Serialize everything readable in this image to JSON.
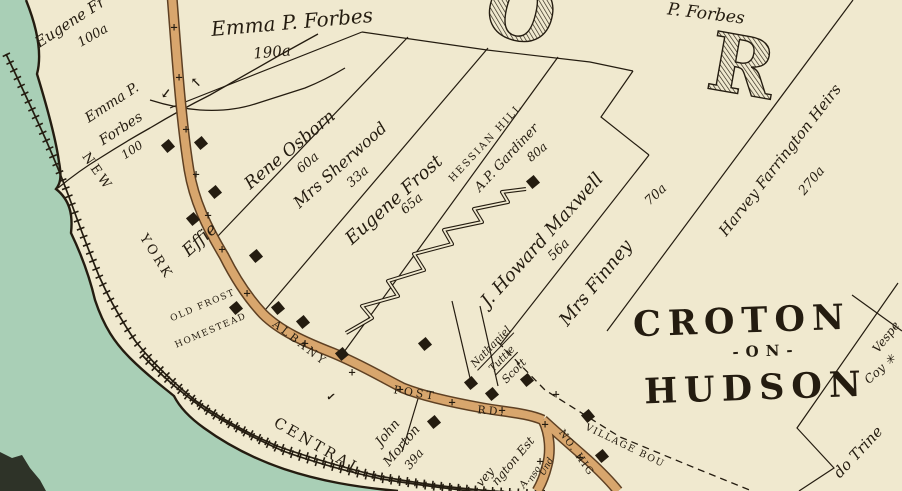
{
  "palette": {
    "paper": "#f0e9cf",
    "water": "#a9cfb6",
    "ink": "#241c10",
    "road-fill": "#d8a66d",
    "road-casing": "#5e4023",
    "blob": "#2e3328"
  },
  "map": {
    "region_title_big_letters": [
      "O",
      "R"
    ],
    "place_name": "CROTON -ON- HUDSON",
    "railroad_name": "NEW YORK CENTRAL",
    "roads": [
      "ALBANY POST RD.",
      "NO. HIG",
      "VILLAGE BOU"
    ],
    "landmark": "OLD FROST HOMESTEAD",
    "parcels": [
      {
        "owner": "Eugene Fr",
        "acreage": "100a"
      },
      {
        "owner": "Emma P. Forbes",
        "acreage": "190a"
      },
      {
        "owner": "Emma P. Forbes",
        "acreage": "100"
      },
      {
        "owner": "P. Forbes",
        "acreage": ""
      },
      {
        "owner": "Effie Rene Osborn",
        "acreage": "60a"
      },
      {
        "owner": "Mrs Sherwood",
        "acreage": "33a"
      },
      {
        "owner": "Eugene Frost",
        "acreage": "65a"
      },
      {
        "owner": "A.P. Gardiner (Hessian Hill)",
        "acreage": "80a"
      },
      {
        "owner": "J. Howard Maxwell",
        "acreage": "56a"
      },
      {
        "owner": "Mrs Finney",
        "acreage": "70a"
      },
      {
        "owner": "Harvey Farrington Heirs",
        "acreage": "270a"
      },
      {
        "owner": "John Morton",
        "acreage": "39a"
      },
      {
        "owner": "Nathaniel Tuttle",
        "acreage": ""
      },
      {
        "owner": "Scott",
        "acreage": ""
      },
      {
        "owner": "Vespe",
        "acreage": ""
      },
      {
        "owner": "Coy",
        "acreage": ""
      },
      {
        "owner": "do Trine",
        "acreage": ""
      }
    ]
  },
  "labels": [
    {
      "name": "parcel-label-eugene-fr",
      "text": "Eugene Fr",
      "x": 70,
      "y": 22,
      "rot": -33,
      "size": 15,
      "cls": "name"
    },
    {
      "name": "acreage-label",
      "text": "100a",
      "x": 93,
      "y": 36,
      "rot": -30,
      "size": 13,
      "cls": "acre"
    },
    {
      "name": "parcel-label-emma-forbes",
      "text": "Emma P. Forbes",
      "x": 292,
      "y": 22,
      "rot": -5,
      "size": 20,
      "cls": "name"
    },
    {
      "name": "acreage-label",
      "text": "190a",
      "x": 272,
      "y": 52,
      "rot": -5,
      "size": 15,
      "cls": "acre"
    },
    {
      "name": "parcel-label-emma-forbes-2",
      "text": "Emma P.",
      "x": 112,
      "y": 103,
      "rot": -33,
      "size": 14,
      "cls": "name"
    },
    {
      "name": "parcel-label-emma-forbes-2",
      "text": "Forbes",
      "x": 121,
      "y": 129,
      "rot": -33,
      "size": 14,
      "cls": "name"
    },
    {
      "name": "acreage-label",
      "text": "100",
      "x": 132,
      "y": 150,
      "rot": -33,
      "size": 12,
      "cls": "acre"
    },
    {
      "name": "parcel-label-p-forbes",
      "text": "P. Forbes",
      "x": 706,
      "y": 14,
      "rot": 7,
      "size": 17,
      "cls": "name"
    },
    {
      "name": "parcel-label-effie",
      "text": "Effie",
      "x": 200,
      "y": 240,
      "rot": -42,
      "size": 17,
      "cls": "name"
    },
    {
      "name": "parcel-label-rene-osborn",
      "text": "Rene Osborn",
      "x": 290,
      "y": 150,
      "rot": -40,
      "size": 17,
      "cls": "name"
    },
    {
      "name": "acreage-label",
      "text": "60a",
      "x": 308,
      "y": 163,
      "rot": -40,
      "size": 13,
      "cls": "acre"
    },
    {
      "name": "parcel-label-mrs-sherwood",
      "text": "Mrs Sherwood",
      "x": 340,
      "y": 165,
      "rot": -42,
      "size": 16,
      "cls": "name"
    },
    {
      "name": "acreage-label",
      "text": "33a",
      "x": 358,
      "y": 177,
      "rot": -42,
      "size": 13,
      "cls": "acre"
    },
    {
      "name": "parcel-label-eugene-frost",
      "text": "Eugene Frost",
      "x": 394,
      "y": 200,
      "rot": -42,
      "size": 18,
      "cls": "name"
    },
    {
      "name": "acreage-label",
      "text": "65a",
      "x": 412,
      "y": 204,
      "rot": -40,
      "size": 13,
      "cls": "acre"
    },
    {
      "name": "place-label-hessian-hill",
      "text": "HESSIAN HILL",
      "x": 486,
      "y": 143,
      "rot": -47,
      "size": 10,
      "cls": "caps"
    },
    {
      "name": "parcel-label-gardiner",
      "text": "A.P. Gardiner",
      "x": 507,
      "y": 158,
      "rot": -47,
      "size": 13,
      "cls": "name"
    },
    {
      "name": "acreage-label",
      "text": "80a",
      "x": 537,
      "y": 152,
      "rot": -40,
      "size": 12,
      "cls": "acre"
    },
    {
      "name": "parcel-label-maxwell",
      "text": "J. Howard Maxwell",
      "x": 542,
      "y": 240,
      "rot": -48,
      "size": 18,
      "cls": "name"
    },
    {
      "name": "acreage-label",
      "text": "56a",
      "x": 559,
      "y": 250,
      "rot": -45,
      "size": 13,
      "cls": "acre"
    },
    {
      "name": "parcel-label-mrs-finney",
      "text": "Mrs Finney",
      "x": 596,
      "y": 283,
      "rot": -51,
      "size": 18,
      "cls": "name"
    },
    {
      "name": "acreage-label",
      "text": "70a",
      "x": 656,
      "y": 195,
      "rot": -43,
      "size": 13,
      "cls": "acre"
    },
    {
      "name": "parcel-label-farrington",
      "text": "Harvey Farrington Heirs",
      "x": 780,
      "y": 160,
      "rot": -52,
      "size": 15,
      "cls": "name"
    },
    {
      "name": "acreage-label",
      "text": "270a",
      "x": 812,
      "y": 181,
      "rot": -50,
      "size": 13,
      "cls": "acre"
    },
    {
      "name": "place-label-croton",
      "text": "CROTON",
      "x": 742,
      "y": 321,
      "rot": -2,
      "size": 35,
      "cls": "bigcaps"
    },
    {
      "name": "place-label-on",
      "text": "-ON-",
      "x": 766,
      "y": 351,
      "rot": -2,
      "size": 15,
      "cls": "bigcaps"
    },
    {
      "name": "place-label-hudson",
      "text": "HUDSON",
      "x": 756,
      "y": 388,
      "rot": -2,
      "size": 35,
      "cls": "bigcaps"
    },
    {
      "name": "railroad-label-new",
      "text": "NEW",
      "x": 97,
      "y": 172,
      "rot": 55,
      "size": 13,
      "cls": "roadcaps"
    },
    {
      "name": "railroad-label-york",
      "text": "YORK",
      "x": 156,
      "y": 257,
      "rot": 58,
      "size": 13,
      "cls": "roadcaps"
    },
    {
      "name": "railroad-label-central",
      "text": "CENTRAL",
      "x": 318,
      "y": 446,
      "rot": 30,
      "size": 15,
      "cls": "roadcaps"
    },
    {
      "name": "road-label-albany",
      "text": "ALBANY",
      "x": 300,
      "y": 343,
      "rot": 38,
      "size": 11,
      "cls": "roadcaps"
    },
    {
      "name": "road-label-post",
      "text": "POST",
      "x": 415,
      "y": 393,
      "rot": 9,
      "size": 11,
      "cls": "roadcaps"
    },
    {
      "name": "road-label-rd",
      "text": "RD.",
      "x": 492,
      "y": 411,
      "rot": 5,
      "size": 11,
      "cls": "roadcaps"
    },
    {
      "name": "landmark-label-old-frost",
      "text": "OLD FROST",
      "x": 203,
      "y": 306,
      "rot": -23,
      "size": 9,
      "cls": "capsS"
    },
    {
      "name": "landmark-label-homestead",
      "text": "HOMESTEAD",
      "x": 211,
      "y": 331,
      "rot": -23,
      "size": 9,
      "cls": "capsS"
    },
    {
      "name": "parcel-label-john-morton",
      "text": "John",
      "x": 388,
      "y": 433,
      "rot": -50,
      "size": 13,
      "cls": "name"
    },
    {
      "name": "parcel-label-john-morton",
      "text": "Morton",
      "x": 402,
      "y": 446,
      "rot": -50,
      "size": 13,
      "cls": "name"
    },
    {
      "name": "acreage-label",
      "text": "39a",
      "x": 414,
      "y": 459,
      "rot": -50,
      "size": 12,
      "cls": "acre"
    },
    {
      "name": "parcel-label-nathaniel",
      "text": "Nathaniel",
      "x": 491,
      "y": 347,
      "rot": -46,
      "size": 10.5,
      "cls": "nameU"
    },
    {
      "name": "parcel-label-tuttle",
      "text": "Tuttle",
      "x": 502,
      "y": 359,
      "rot": -46,
      "size": 10.5,
      "cls": "nameU"
    },
    {
      "name": "parcel-label-scott",
      "text": "Scott",
      "x": 514,
      "y": 371,
      "rot": -46,
      "size": 11,
      "cls": "name"
    },
    {
      "name": "boundary-label-village",
      "text": "VILLAGE  BOU",
      "x": 625,
      "y": 446,
      "rot": 26,
      "size": 9.5,
      "cls": "capsS"
    },
    {
      "name": "road-label-no-highland",
      "text": "NO. HIG",
      "x": 576,
      "y": 453,
      "rot": 55,
      "size": 10,
      "cls": "capsS"
    },
    {
      "name": "parcel-label-fragment",
      "text": "vey",
      "x": 485,
      "y": 477,
      "rot": -50,
      "size": 12,
      "cls": "name"
    },
    {
      "name": "parcel-label-fragment",
      "text": "ngton Est",
      "x": 513,
      "y": 461,
      "rot": -50,
      "size": 12,
      "cls": "name"
    },
    {
      "name": "parcel-label-fragment",
      "text": "A.",
      "x": 525,
      "y": 483,
      "rot": -55,
      "size": 10,
      "cls": "name"
    },
    {
      "name": "parcel-label-fragment",
      "text": "nso",
      "x": 535,
      "y": 474,
      "rot": -60,
      "size": 9,
      "cls": "name"
    },
    {
      "name": "parcel-label-fragment",
      "text": "Und",
      "x": 547,
      "y": 467,
      "rot": -60,
      "size": 9,
      "cls": "name"
    },
    {
      "name": "parcel-label-vespe",
      "text": "Vespe",
      "x": 886,
      "y": 337,
      "rot": -52,
      "size": 12,
      "cls": "name"
    },
    {
      "name": "parcel-label-coy",
      "text": "Coy ✳",
      "x": 880,
      "y": 369,
      "rot": -42,
      "size": 12,
      "cls": "name"
    },
    {
      "name": "parcel-label-do-trine",
      "text": "do Trine",
      "x": 858,
      "y": 452,
      "rot": -47,
      "size": 15,
      "cls": "name"
    },
    {
      "name": "big-letter-o",
      "text": "O",
      "x": 521,
      "y": 12,
      "rot": 14,
      "size": 80,
      "cls": "bigletter"
    },
    {
      "name": "big-letter-r",
      "text": "R",
      "x": 742,
      "y": 66,
      "rot": 10,
      "size": 80,
      "cls": "bigletter"
    },
    {
      "name": "survey-arrow-icon",
      "text": "↙",
      "x": 166,
      "y": 94,
      "rot": -8,
      "size": 13,
      "cls": "mark"
    },
    {
      "name": "survey-arrow-icon",
      "text": "↖",
      "x": 196,
      "y": 83,
      "rot": 0,
      "size": 13,
      "cls": "mark"
    },
    {
      "name": "survey-check-icon",
      "text": "✓",
      "x": 331,
      "y": 397,
      "rot": 10,
      "size": 11,
      "cls": "mark"
    }
  ],
  "buildings": [
    {
      "x": 168,
      "y": 146
    },
    {
      "x": 201,
      "y": 143
    },
    {
      "x": 215,
      "y": 192
    },
    {
      "x": 193,
      "y": 219
    },
    {
      "x": 256,
      "y": 256
    },
    {
      "x": 278,
      "y": 308
    },
    {
      "x": 236,
      "y": 308
    },
    {
      "x": 303,
      "y": 322
    },
    {
      "x": 342,
      "y": 354
    },
    {
      "x": 425,
      "y": 344
    },
    {
      "x": 434,
      "y": 422
    },
    {
      "x": 471,
      "y": 383
    },
    {
      "x": 492,
      "y": 394
    },
    {
      "x": 527,
      "y": 380
    },
    {
      "x": 533,
      "y": 182
    },
    {
      "x": 588,
      "y": 416
    },
    {
      "x": 602,
      "y": 456
    }
  ],
  "road_cross_marks": [
    {
      "x": 174,
      "y": 28
    },
    {
      "x": 179,
      "y": 78
    },
    {
      "x": 186,
      "y": 130
    },
    {
      "x": 196,
      "y": 175
    },
    {
      "x": 208,
      "y": 216
    },
    {
      "x": 222,
      "y": 250
    },
    {
      "x": 247,
      "y": 294
    },
    {
      "x": 305,
      "y": 344
    },
    {
      "x": 352,
      "y": 373
    },
    {
      "x": 400,
      "y": 390
    },
    {
      "x": 452,
      "y": 403
    },
    {
      "x": 502,
      "y": 411
    },
    {
      "x": 545,
      "y": 425
    },
    {
      "x": 556,
      "y": 395
    },
    {
      "x": 580,
      "y": 458
    },
    {
      "x": 540,
      "y": 462
    }
  ]
}
